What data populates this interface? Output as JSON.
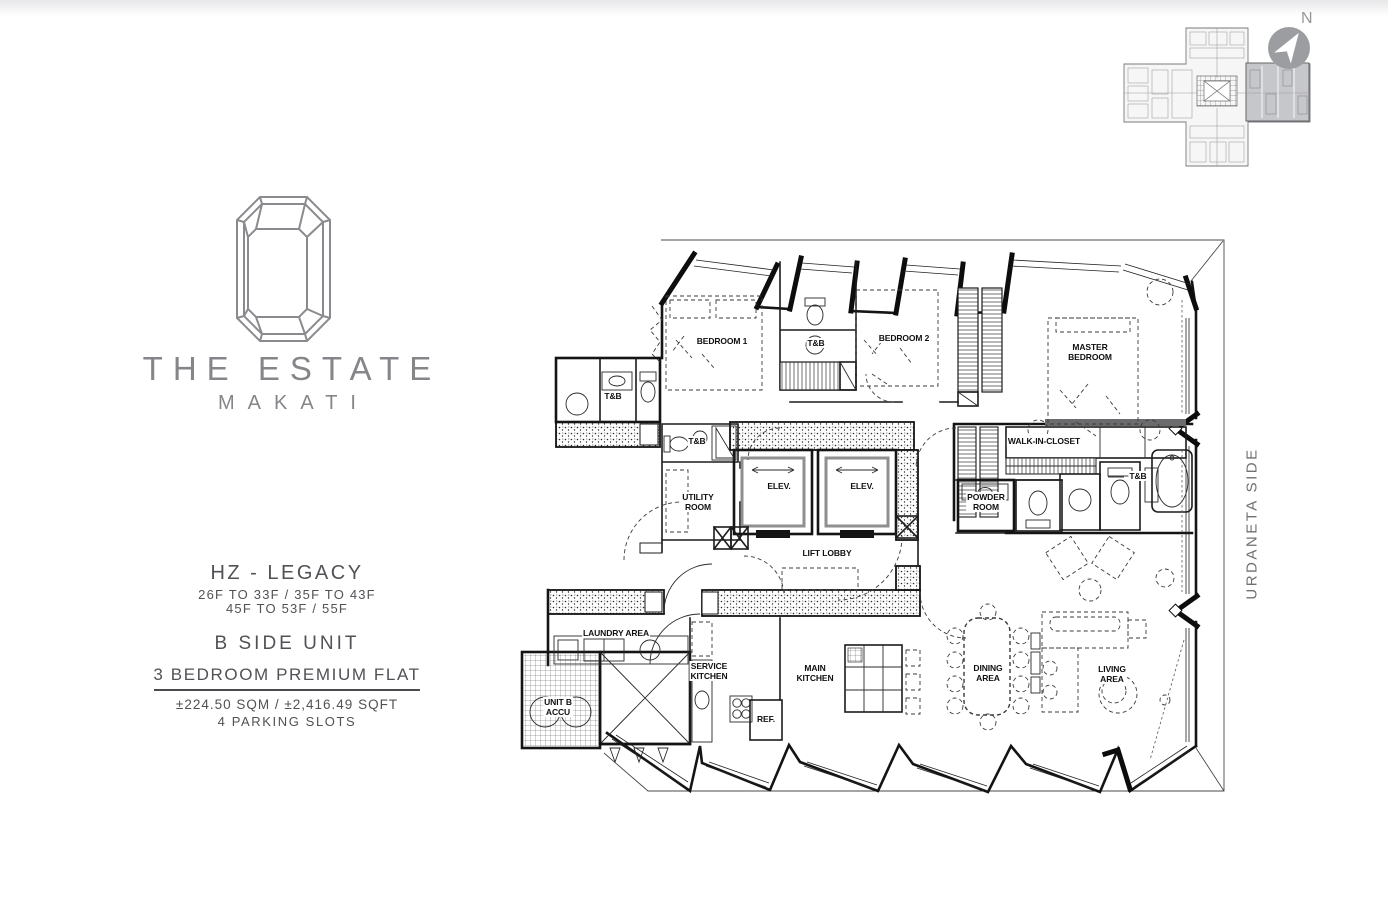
{
  "branding": {
    "logo": "emerald-gem-icon",
    "title": "THE ESTATE",
    "subtitle": "MAKATI"
  },
  "unit_info": {
    "tower": "HZ - LEGACY",
    "floors_line1": "26F TO 33F / 35F TO 43F",
    "floors_line2": "45F TO 53F / 55F",
    "unit_name": "B SIDE UNIT",
    "unit_type": "3 BEDROOM PREMIUM FLAT",
    "area": "±224.50 SQM / ±2,416.49 SQFT",
    "parking": "4 PARKING SLOTS"
  },
  "orientation": {
    "compass_label": "N",
    "side_label": "URDANETA SIDE"
  },
  "key_plan": {
    "shape": "cross-shaped tower floor plate",
    "highlighted_wing": "east wing (B side unit)",
    "highlight_color": "#c6c7ca"
  },
  "floor_plan": {
    "labels": [
      {
        "id": "bedroom-1",
        "text": "BEDROOM 1",
        "x": 722,
        "y": 341
      },
      {
        "id": "tb-common",
        "text": "T&B",
        "x": 613,
        "y": 396
      },
      {
        "id": "tb-bedroom-1",
        "text": "T&B",
        "x": 816,
        "y": 343
      },
      {
        "id": "bedroom-2",
        "text": "BEDROOM 2",
        "x": 904,
        "y": 338
      },
      {
        "id": "master-bedroom",
        "text": "MASTER\nBEDROOM",
        "x": 1090,
        "y": 352
      },
      {
        "id": "walk-in-closet",
        "text": "WALK-IN-CLOSET",
        "x": 1044,
        "y": 441
      },
      {
        "id": "tb-master",
        "text": "T&B",
        "x": 1138,
        "y": 476
      },
      {
        "id": "powder-room",
        "text": "POWDER\nROOM",
        "x": 986,
        "y": 502
      },
      {
        "id": "elevator-1",
        "text": "ELEV.",
        "x": 779,
        "y": 486
      },
      {
        "id": "elevator-2",
        "text": "ELEV.",
        "x": 862,
        "y": 486
      },
      {
        "id": "lift-lobby",
        "text": "LIFT LOBBY",
        "x": 827,
        "y": 553
      },
      {
        "id": "tb-utility",
        "text": "T&B",
        "x": 697,
        "y": 441
      },
      {
        "id": "utility-room",
        "text": "UTILITY\nROOM",
        "x": 698,
        "y": 502
      },
      {
        "id": "laundry-area",
        "text": "LAUNDRY AREA",
        "x": 616,
        "y": 633
      },
      {
        "id": "unit-b-accu",
        "text": "UNIT B\nACCU",
        "x": 558,
        "y": 707
      },
      {
        "id": "service-kitchen",
        "text": "SERVICE\nKITCHEN",
        "x": 709,
        "y": 671
      },
      {
        "id": "ref",
        "text": "REF.",
        "x": 766,
        "y": 719
      },
      {
        "id": "main-kitchen",
        "text": "MAIN\nKITCHEN",
        "x": 815,
        "y": 673
      },
      {
        "id": "dining-area",
        "text": "DINING\nAREA",
        "x": 988,
        "y": 673
      },
      {
        "id": "living-area",
        "text": "LIVING\nAREA",
        "x": 1112,
        "y": 674
      }
    ]
  },
  "colors": {
    "brand_gray": "#85868a",
    "text_gray": "#515256",
    "plan_line": "#141414",
    "compass_gray": "#9c9da1",
    "key_plan_highlight": "#c6c7ca"
  }
}
